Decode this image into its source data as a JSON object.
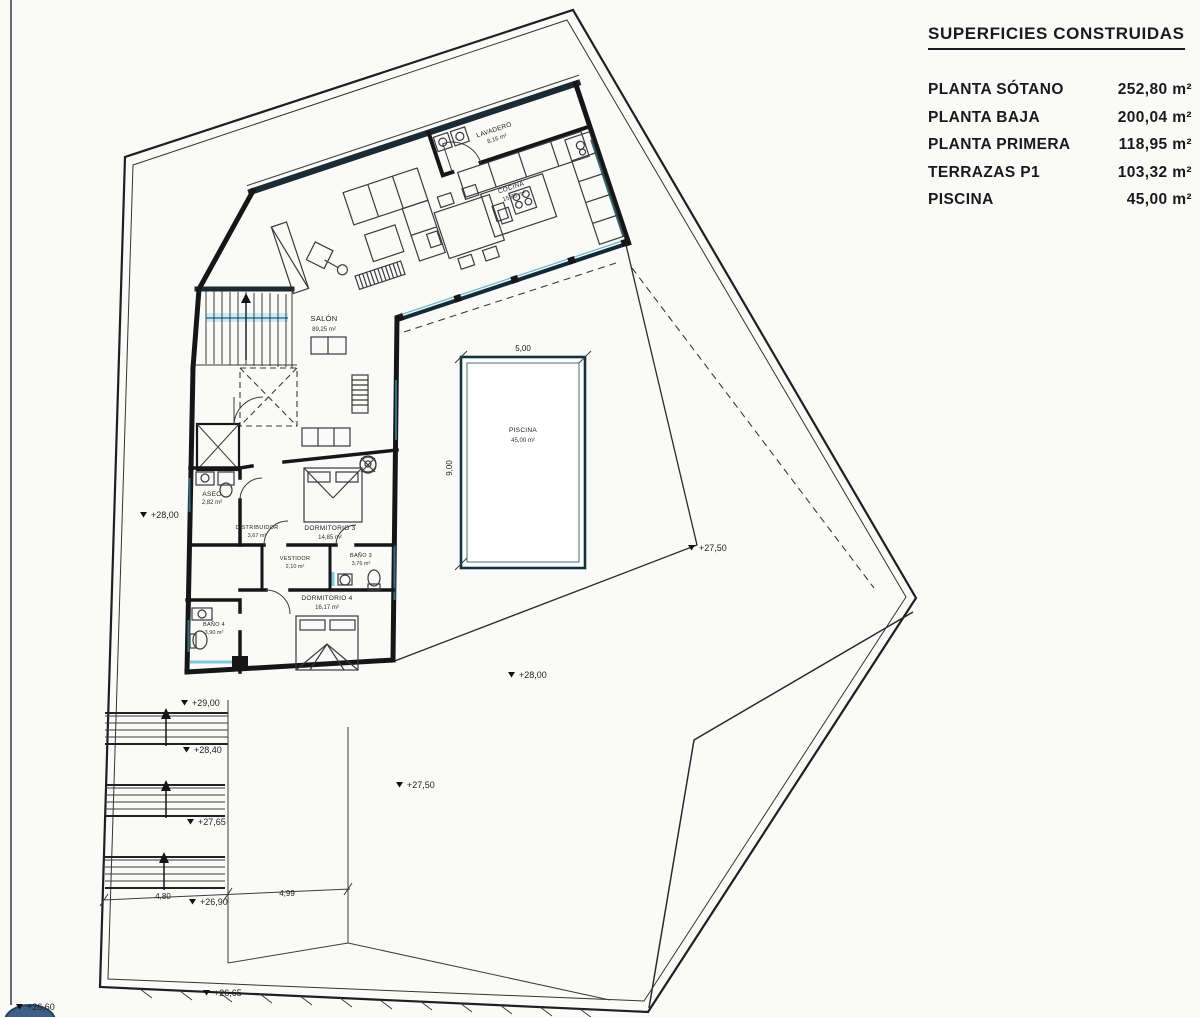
{
  "legend": {
    "title": "SUPERFICIES CONSTRUIDAS",
    "items": [
      {
        "label": "PLANTA SÓTANO",
        "value": "252,80 m²"
      },
      {
        "label": "PLANTA BAJA",
        "value": "200,04 m²"
      },
      {
        "label": "PLANTA PRIMERA",
        "value": "118,95 m²"
      },
      {
        "label": "TERRAZAS P1",
        "value": "103,32 m²"
      },
      {
        "label": "PISCINA",
        "value": "45,00 m²"
      }
    ]
  },
  "rooms": {
    "salon": {
      "name": "SALÓN",
      "area": "89,25 m²"
    },
    "cocina": {
      "name": "COCINA",
      "area": "15,88 m²"
    },
    "lavadero": {
      "name": "LAVADERO",
      "area": "8,16 m²"
    },
    "aseo": {
      "name": "ASEO",
      "area": "2,82 m²"
    },
    "distribuidor": {
      "name": "DISTRIBUIDOR",
      "area": "3,67 m²"
    },
    "dormitorio3": {
      "name": "DORMITORIO 3",
      "area": "14,85 m²"
    },
    "vestidor": {
      "name": "VESTIDOR",
      "area": "2,10 m²"
    },
    "bano3": {
      "name": "BAÑO 3",
      "area": "3,76 m²"
    },
    "dormitorio4": {
      "name": "DORMITORIO 4",
      "area": "16,17 m²"
    },
    "bano4": {
      "name": "BAÑO 4",
      "area": "3,90 m²"
    },
    "piscina": {
      "name": "PISCINA",
      "area": "45,00 m²"
    }
  },
  "dimensions": {
    "pool_width": "5,00",
    "pool_depth": "9,00",
    "stair_width": "4,80",
    "path_width": "4,99"
  },
  "levels": {
    "west_terrace": "+28,00",
    "east_garden": "+27,50",
    "south_terrace": "+28,00",
    "stair_top": "+29,00",
    "stair_landing1": "+28,40",
    "stair_landing2": "+27,65",
    "stair_bottom": "+26,90",
    "garden_low": "+26,65",
    "garden_lowest": "+26,60",
    "path": "+27,50"
  },
  "colors": {
    "wall": "#161616",
    "wall_blue": "#1b2a33",
    "glass_frame": "#2e6077",
    "glass_highlight": "#9fdcec",
    "stair_glass": "#cdeaf2",
    "annotation_dot": "#3d5f85",
    "paper": "#fafaf8"
  }
}
